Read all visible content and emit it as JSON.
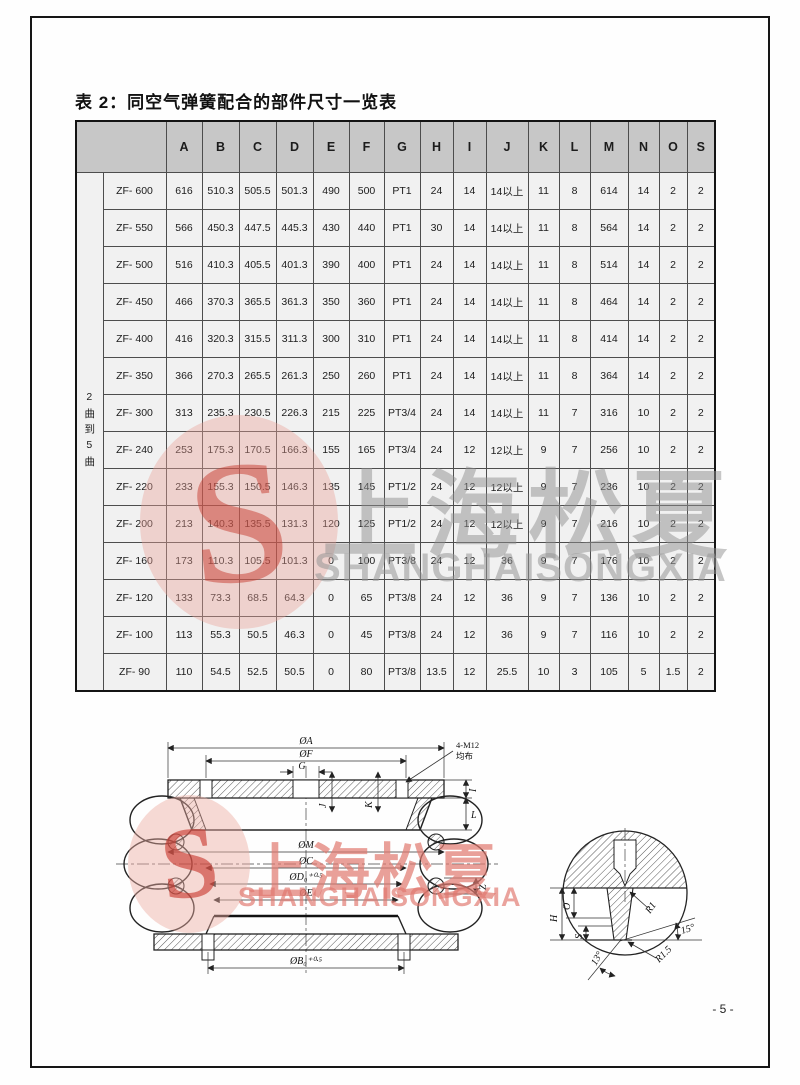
{
  "page": {
    "title": "表 2：同空气弹簧配合的部件尺寸一览表",
    "page_number": "- 5 -"
  },
  "watermark": {
    "cn": "上海松夏",
    "en": "SHANGHAISONGXIA",
    "logo_letter": "S",
    "red": "#c63c30",
    "pink": "#eca298",
    "gray": "#909090"
  },
  "table": {
    "row_group_label": "2曲到5曲",
    "columns": [
      "A",
      "B",
      "C",
      "D",
      "E",
      "F",
      "G",
      "H",
      "I",
      "J",
      "K",
      "L",
      "M",
      "N",
      "O",
      "S"
    ],
    "rows": [
      {
        "name": "ZF- 600",
        "values": [
          "616",
          "510.3",
          "505.5",
          "501.3",
          "490",
          "500",
          "PT1",
          "24",
          "14",
          "14以上",
          "11",
          "8",
          "614",
          "14",
          "2",
          "2"
        ]
      },
      {
        "name": "ZF- 550",
        "values": [
          "566",
          "450.3",
          "447.5",
          "445.3",
          "430",
          "440",
          "PT1",
          "30",
          "14",
          "14以上",
          "11",
          "8",
          "564",
          "14",
          "2",
          "2"
        ]
      },
      {
        "name": "ZF- 500",
        "values": [
          "516",
          "410.3",
          "405.5",
          "401.3",
          "390",
          "400",
          "PT1",
          "24",
          "14",
          "14以上",
          "11",
          "8",
          "514",
          "14",
          "2",
          "2"
        ]
      },
      {
        "name": "ZF- 450",
        "values": [
          "466",
          "370.3",
          "365.5",
          "361.3",
          "350",
          "360",
          "PT1",
          "24",
          "14",
          "14以上",
          "11",
          "8",
          "464",
          "14",
          "2",
          "2"
        ]
      },
      {
        "name": "ZF- 400",
        "values": [
          "416",
          "320.3",
          "315.5",
          "311.3",
          "300",
          "310",
          "PT1",
          "24",
          "14",
          "14以上",
          "11",
          "8",
          "414",
          "14",
          "2",
          "2"
        ]
      },
      {
        "name": "ZF- 350",
        "values": [
          "366",
          "270.3",
          "265.5",
          "261.3",
          "250",
          "260",
          "PT1",
          "24",
          "14",
          "14以上",
          "11",
          "8",
          "364",
          "14",
          "2",
          "2"
        ]
      },
      {
        "name": "ZF- 300",
        "values": [
          "313",
          "235.3",
          "230.5",
          "226.3",
          "215",
          "225",
          "PT3/4",
          "24",
          "14",
          "14以上",
          "11",
          "7",
          "316",
          "10",
          "2",
          "2"
        ]
      },
      {
        "name": "ZF- 240",
        "values": [
          "253",
          "175.3",
          "170.5",
          "166.3",
          "155",
          "165",
          "PT3/4",
          "24",
          "12",
          "12以上",
          "9",
          "7",
          "256",
          "10",
          "2",
          "2"
        ]
      },
      {
        "name": "ZF- 220",
        "values": [
          "233",
          "155.3",
          "150.5",
          "146.3",
          "135",
          "145",
          "PT1/2",
          "24",
          "12",
          "12以上",
          "9",
          "7",
          "236",
          "10",
          "2",
          "2"
        ]
      },
      {
        "name": "ZF- 200",
        "values": [
          "213",
          "140.3",
          "135.5",
          "131.3",
          "120",
          "125",
          "PT1/2",
          "24",
          "12",
          "12以上",
          "9",
          "7",
          "216",
          "10",
          "2",
          "2"
        ]
      },
      {
        "name": "ZF- 160",
        "values": [
          "173",
          "110.3",
          "105.5",
          "101.3",
          "0",
          "100",
          "PT3/8",
          "24",
          "12",
          "36",
          "9",
          "7",
          "176",
          "10",
          "2",
          "2"
        ]
      },
      {
        "name": "ZF- 120",
        "values": [
          "133",
          "73.3",
          "68.5",
          "64.3",
          "0",
          "65",
          "PT3/8",
          "24",
          "12",
          "36",
          "9",
          "7",
          "136",
          "10",
          "2",
          "2"
        ]
      },
      {
        "name": "ZF- 100",
        "values": [
          "113",
          "55.3",
          "50.5",
          "46.3",
          "0",
          "45",
          "PT3/8",
          "24",
          "12",
          "36",
          "9",
          "7",
          "116",
          "10",
          "2",
          "2"
        ]
      },
      {
        "name": "ZF- 90",
        "values": [
          "110",
          "54.5",
          "52.5",
          "50.5",
          "0",
          "80",
          "PT3/8",
          "13.5",
          "12",
          "25.5",
          "10",
          "3",
          "105",
          "5",
          "1.5",
          "2"
        ]
      }
    ]
  },
  "drawing": {
    "main": {
      "oa": "ØA",
      "of": "ØF",
      "g": "G",
      "bolt": "4-M12",
      "bolt_note": "均布",
      "i": "I",
      "l": "L",
      "j": "J",
      "k": "K",
      "z": "Z",
      "om": "ØM",
      "oc": "ØC",
      "od": "ØD₀⁺⁰·⁵",
      "oe": "ØE",
      "ob": "ØB₀⁺⁰·⁵"
    },
    "detail": {
      "h": "H",
      "o": "O",
      "s": "S",
      "r1": "R1",
      "r1_5": "R1.5",
      "angle_a": "13°",
      "angle_b": "15°"
    }
  }
}
